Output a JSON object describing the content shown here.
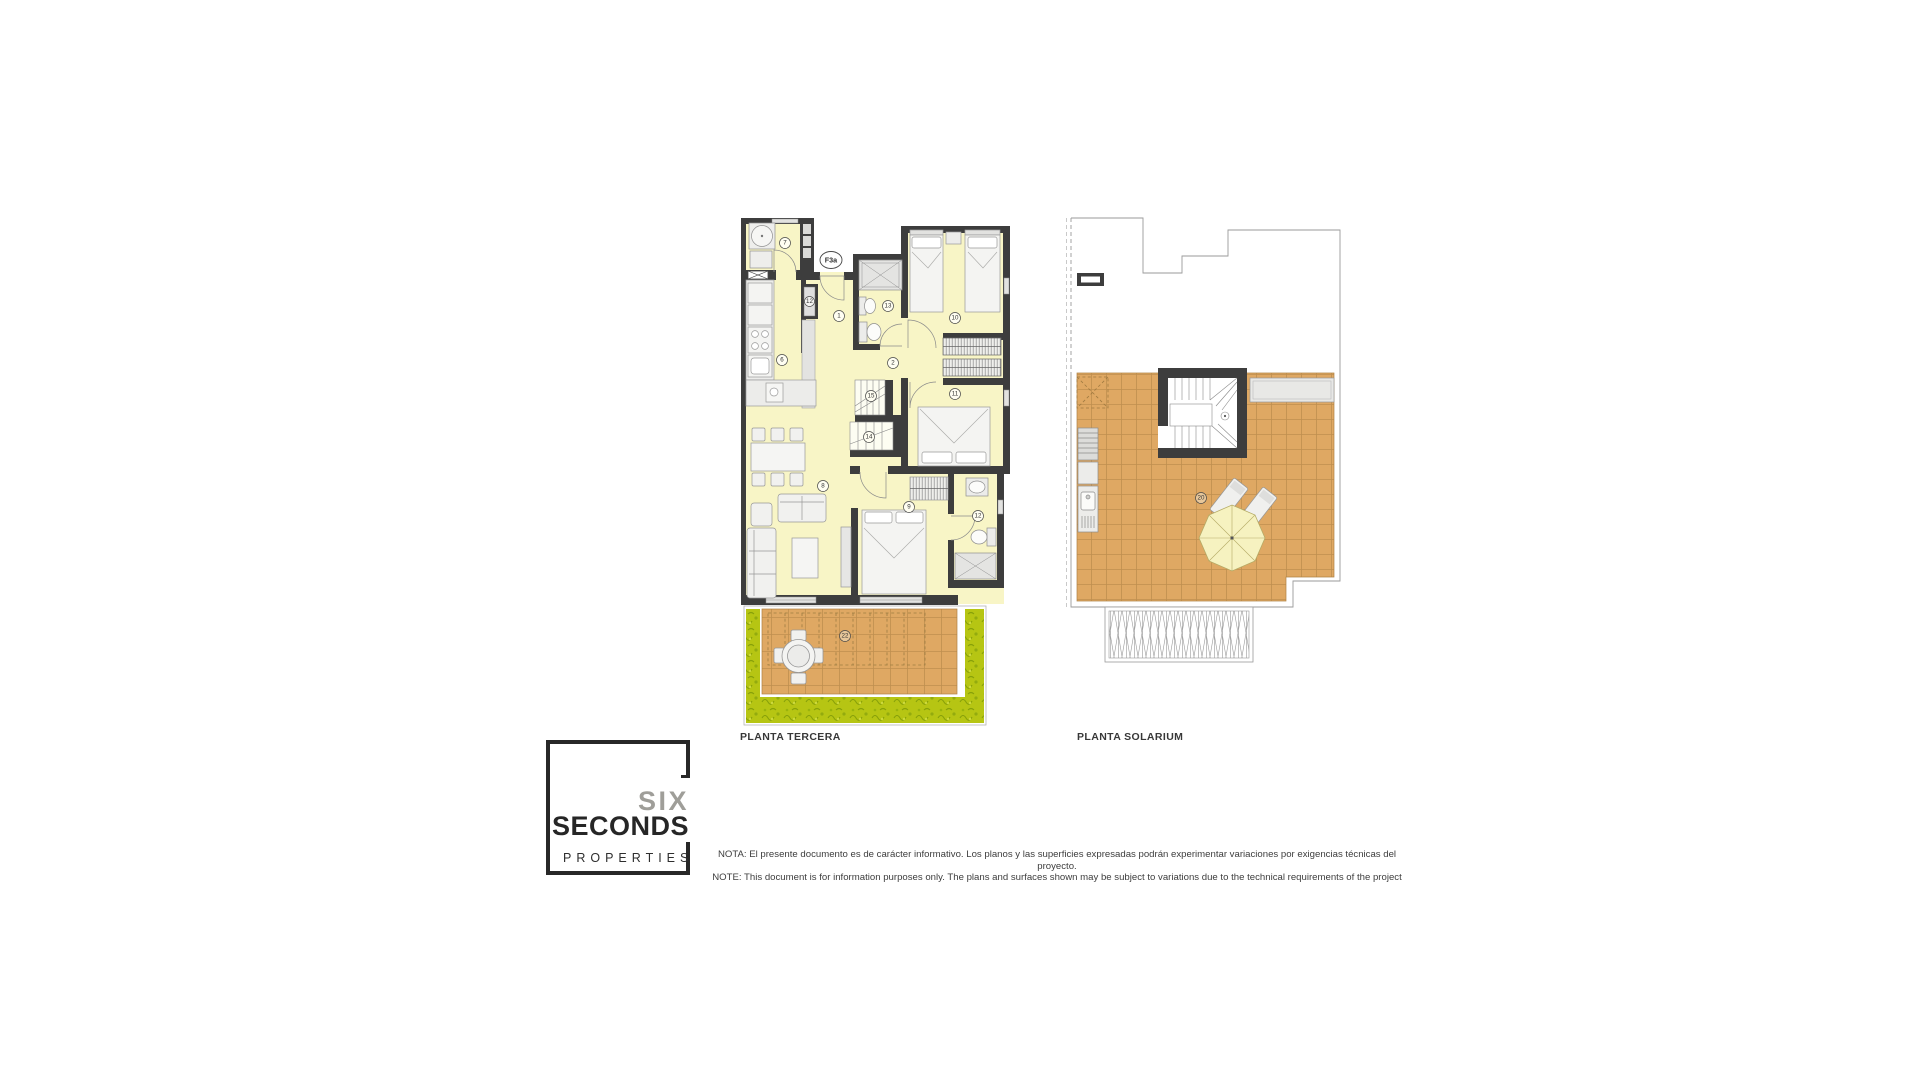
{
  "plans": {
    "tercera": {
      "title": "PLANTA TERCERA",
      "unit_label": "F3a",
      "rooms": {
        "utility": "7",
        "closet": "12",
        "hall": "1",
        "bath_top": "13",
        "bedroom_top": "10",
        "distributor": "2",
        "kitchen": "6",
        "stair_upper": "15",
        "stair_lower": "14",
        "bedroom_mid": "11",
        "living": "8",
        "bedroom_main": "9",
        "bath_main": "12",
        "terrace": "22"
      }
    },
    "solarium": {
      "title": "PLANTA SOLARIUM",
      "rooms": {
        "solarium": "20"
      }
    }
  },
  "logo": {
    "line1": "SIX",
    "line2": "SECONDS",
    "line3": "PROPERTIES"
  },
  "note": {
    "line1": "NOTA: El presente documento es de carácter informativo. Los planos y las superficies expresadas podrán experimentar variaciones por exigencias técnicas del proyecto.",
    "line2": "NOTE: This document is for information purposes only. The plans and surfaces shown may be subject to variations due to the technical requirements of the project"
  },
  "colors": {
    "wall": "#3d3d3d",
    "floor": "#f8f5c6",
    "tile": "#dfa863",
    "tile_line": "#bf8f4f",
    "grass": "#b6c513",
    "furniture": "#f1f1ef",
    "outline": "#9a9a9a",
    "logo_gray": "#9f9e99",
    "logo_black": "#262626"
  }
}
